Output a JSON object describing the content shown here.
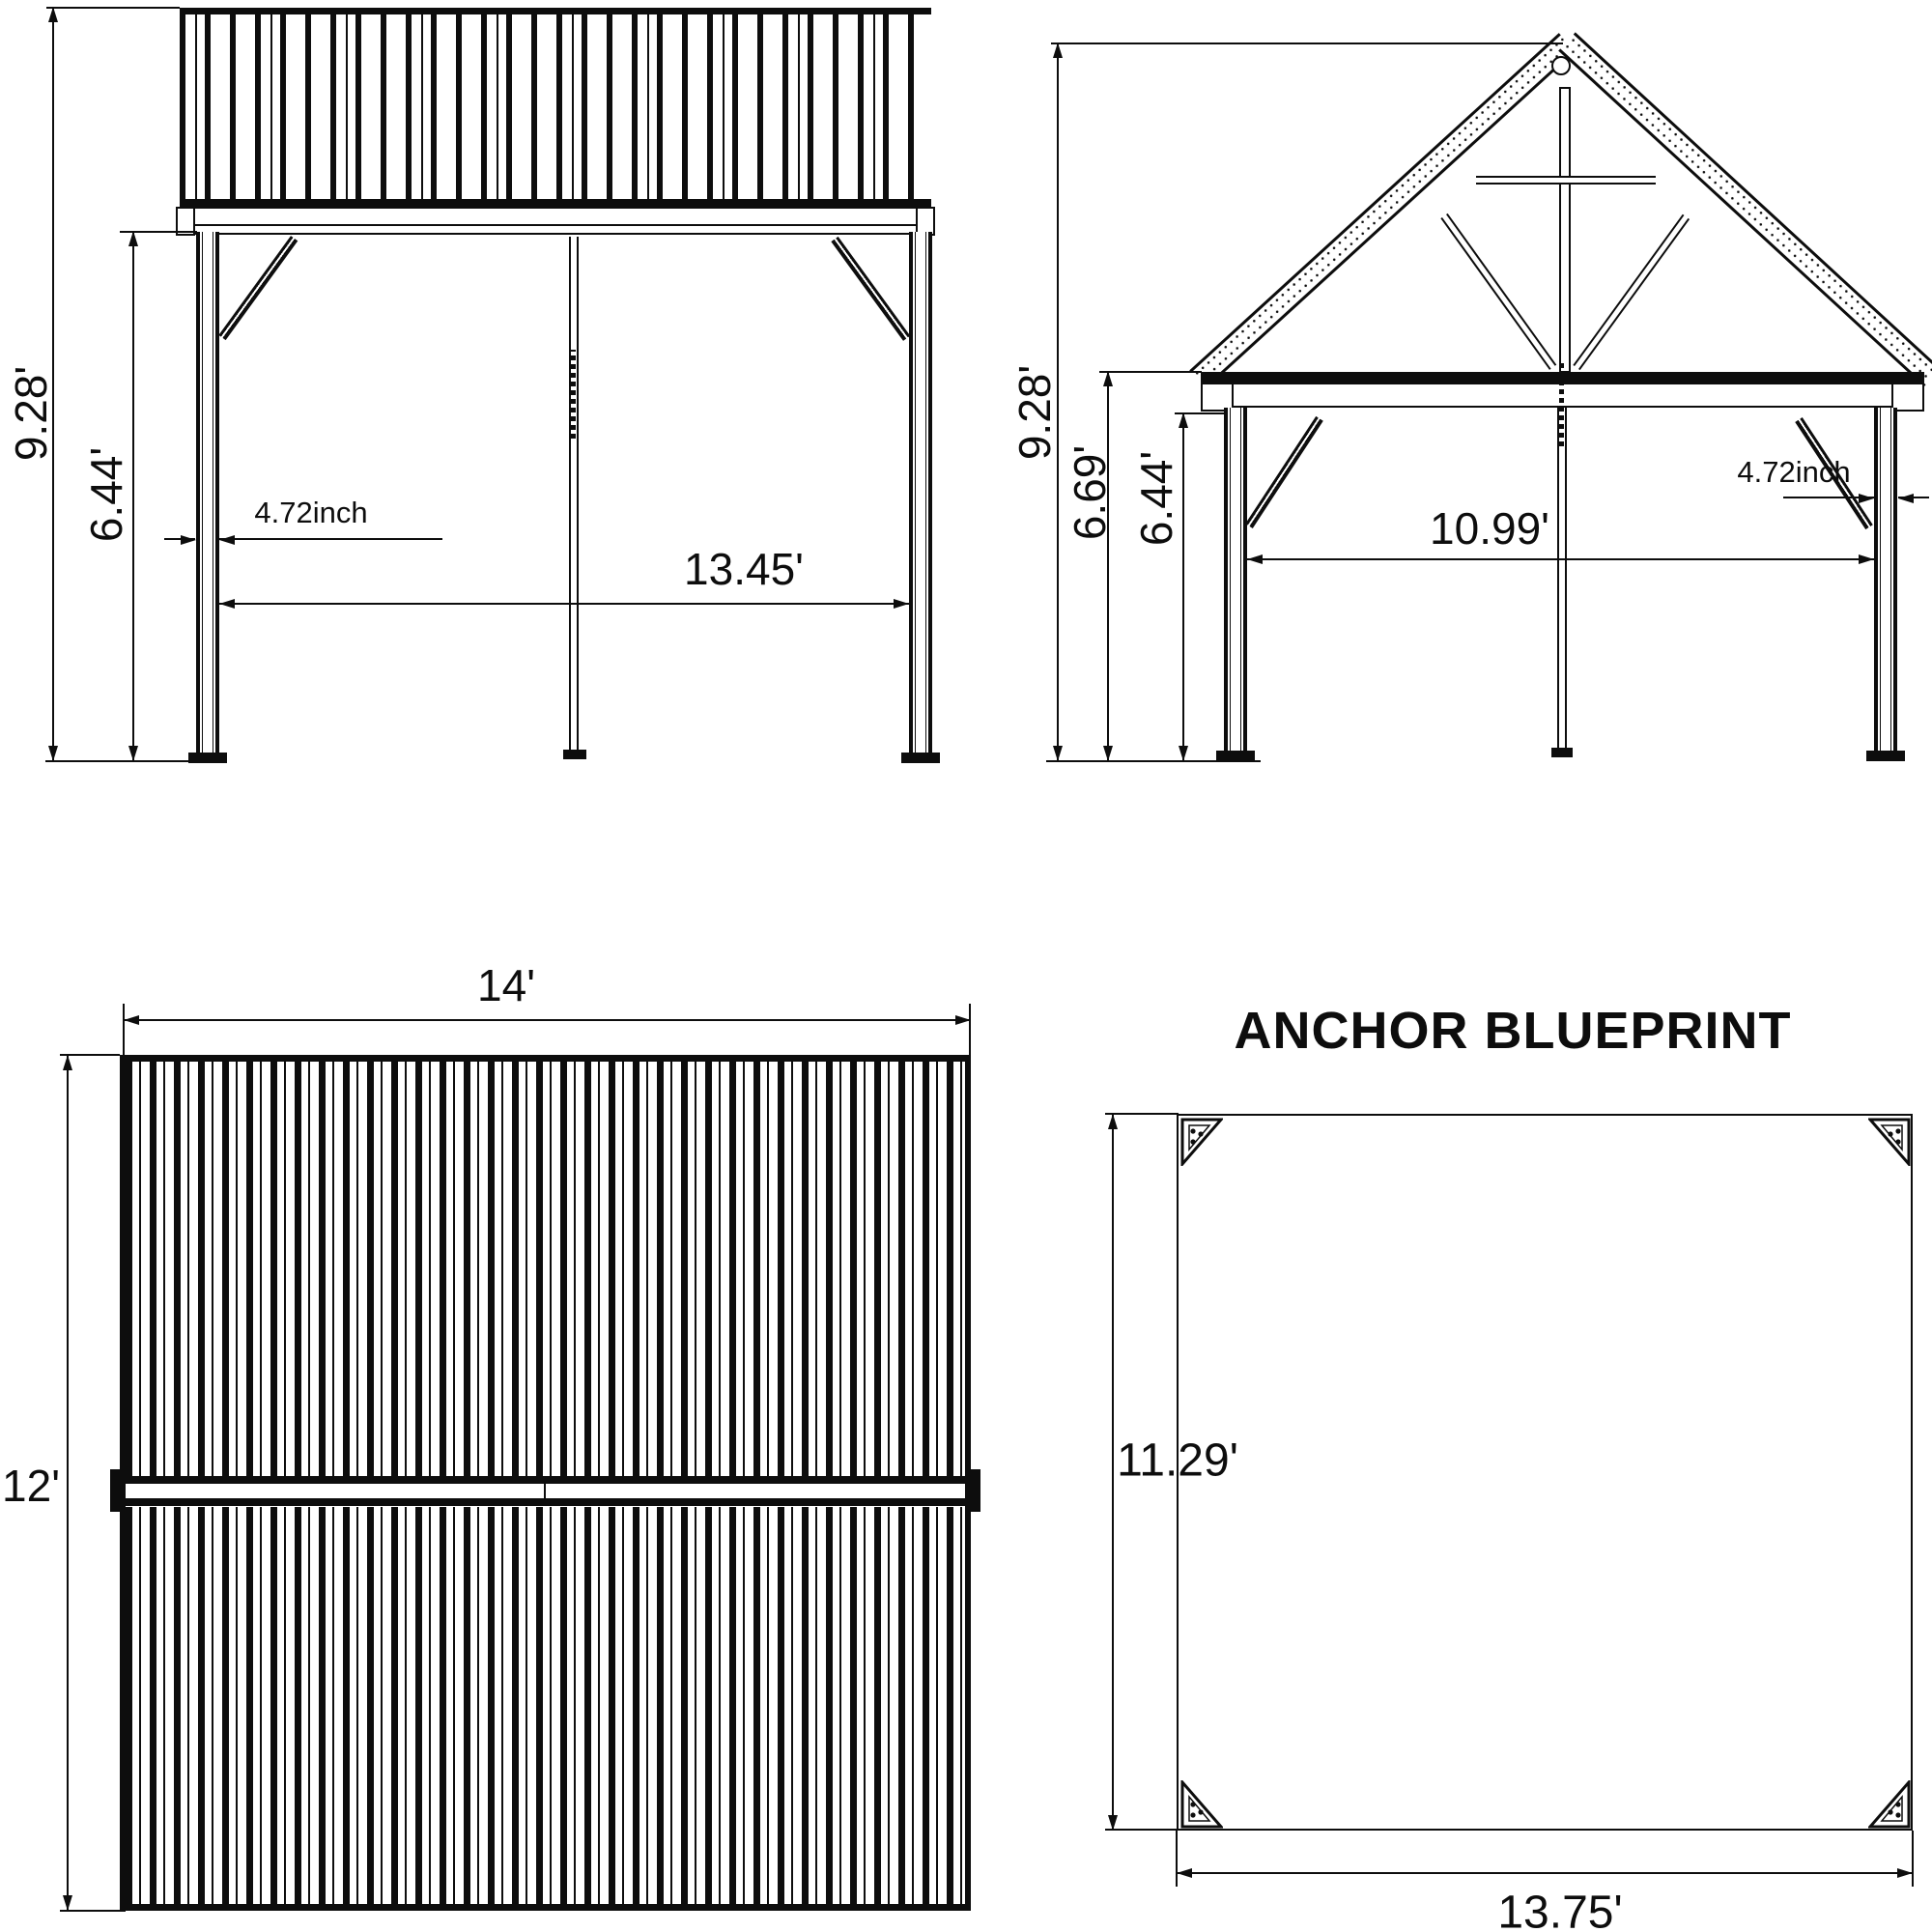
{
  "side_view": {
    "height_overall": "9.28'",
    "height_post": "6.44'",
    "post_width": "4.72inch",
    "span": "13.45'"
  },
  "front_view": {
    "height_overall": "9.28'",
    "height_eave": "6.69'",
    "height_post": "6.44'",
    "post_width": "4.72inch",
    "span": "10.99'"
  },
  "roof_plan": {
    "width": "14'",
    "depth": "12'"
  },
  "anchor_plan": {
    "title": "ANCHOR BLUEPRINT",
    "depth": "11.29'",
    "width": "13.75'"
  },
  "colors": {
    "line": "#0d0d0d",
    "background": "#ffffff"
  }
}
